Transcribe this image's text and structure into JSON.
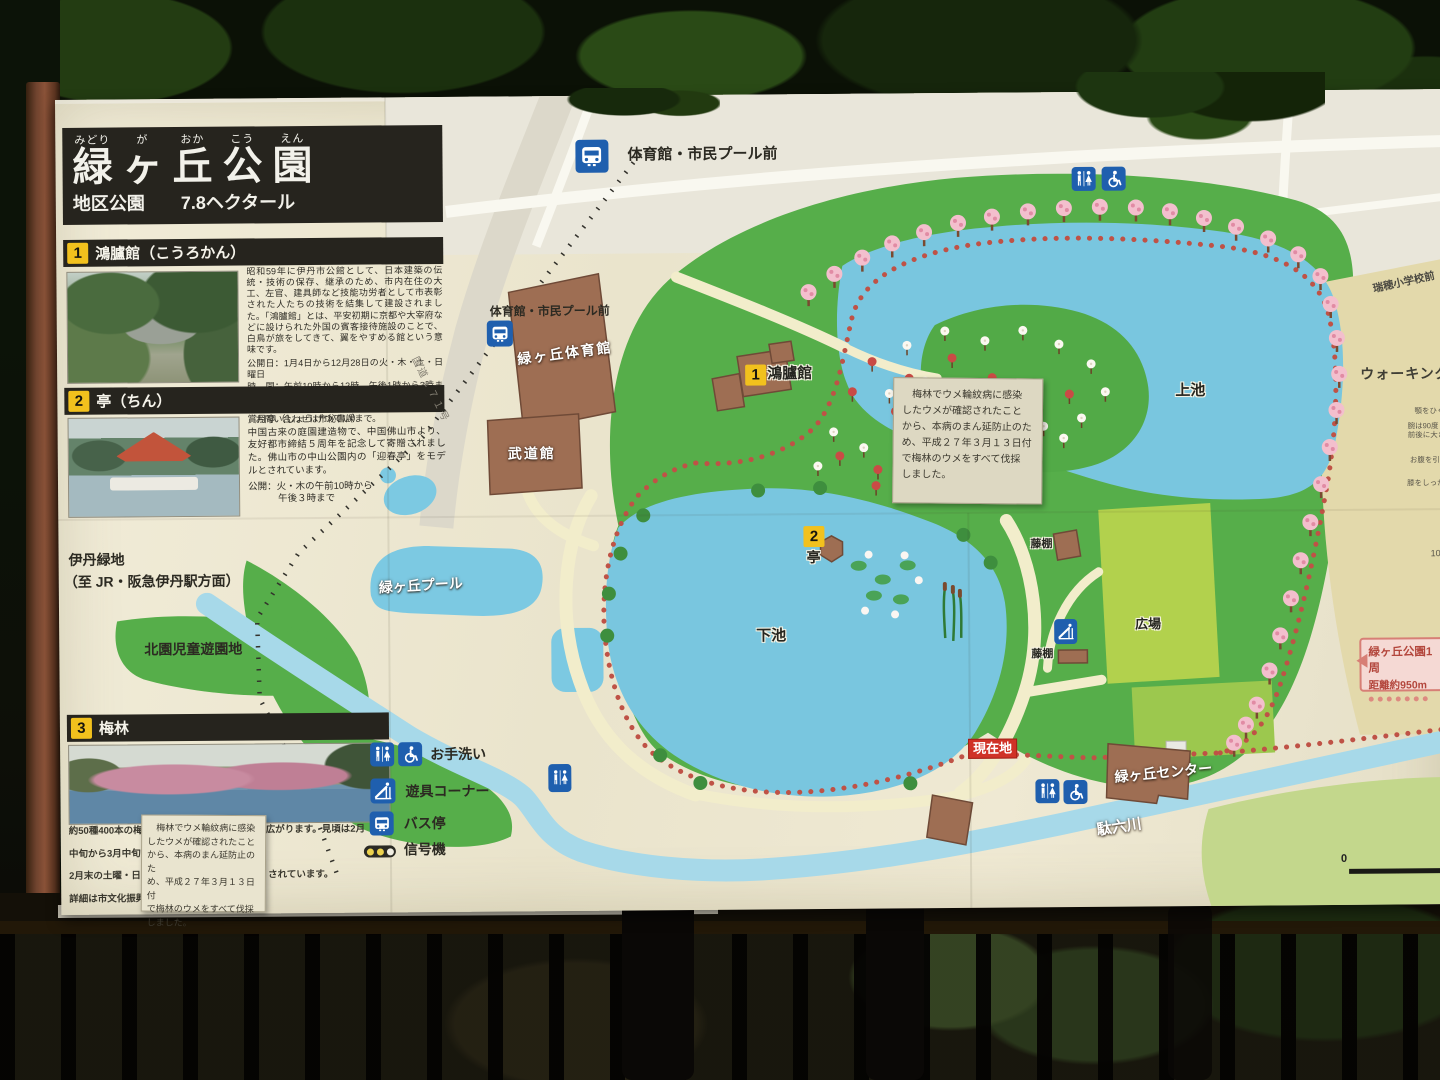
{
  "title": {
    "furigana": [
      "みどり",
      "が",
      "おか",
      "こう",
      "えん"
    ],
    "kanji": [
      "緑",
      "ヶ",
      "丘",
      "公",
      "園"
    ],
    "subtitle_left": "地区公園",
    "subtitle_right": "7.8ヘクタール"
  },
  "box1": {
    "num": "1",
    "heading": "鴻臚館（こうろかん）",
    "body": "昭和59年に伊丹市公館として、日本建築の伝統・技術の保存、継承のため、市内在住の大工、左官、建具師など技能功労者として市表彰された人たちの技術を結集して建設されました。「鴻臚館」とは、平安初期に京都や大宰府などに設けられた外国の賓客接待施設のことで、白鳥が旅をしてきて、翼をやすめる館という意味です。",
    "open_days": "公開日：1月4日から12月28日の火・木・土・日曜日",
    "open_hours": "時　間：午前10時から12時、午後1時から3時まで",
    "note1": "※行事等で見学できない場合もあります。",
    "note2": "お問い合わせは市秘書課まで。"
  },
  "box2": {
    "num": "2",
    "heading": "亭（ちん）",
    "subname": "賞月亭（しょうげつてい）",
    "body": "中国古来の庭園建造物で、中国佛山市より、友好都市締結５周年を記念して寄贈されました。佛山市の中山公園内の「迎春亭」をモデルとされています。",
    "open1": "公開：火・木の午前10時から",
    "open2": "午後３時まで"
  },
  "box3": {
    "num": "3",
    "heading": "梅林",
    "line1_left": "約50種400本の梅が",
    "line1_right": "広がります。見頃は2月",
    "line2_left": "中旬から3月中旬です",
    "line3_left": "2月末の土曜・日曜日",
    "line3_right": "されています。",
    "line4_left": "詳細は市文化振興課"
  },
  "plum_notice": {
    "l1": "　梅林でウメ輪紋病に感染",
    "l2": "したウメが確認されたこと",
    "l3": "から、本病のまん延防止のた",
    "l4": "め、平成２７年３月１３日付",
    "l5": "で梅林のウメをすべて伐採",
    "l6": "しました。"
  },
  "legend": {
    "toilet": "お手洗い",
    "playground": "遊具コーナー",
    "bus_stop": "バス停",
    "signal": "信号機"
  },
  "map_labels": {
    "bus_stop_top": "体育館・市民プール前",
    "bus_stop_gym": "体育館・市民プール前",
    "gym": "緑ヶ丘体育館",
    "budokan": "武道館",
    "pool": "緑ヶ丘プール",
    "kourokan_num": "1",
    "kourokan": "鴻臚館",
    "tei_num": "2",
    "tei": "亭",
    "upper_pond": "上池",
    "lower_pond": "下池",
    "fujidana_a": "藤棚",
    "fujidana_b": "藤棚",
    "hiroba": "広場",
    "center": "緑ヶ丘センター",
    "river": "駄六川",
    "current_location": "現在地",
    "kitazono": "北園児童遊園地",
    "itami_line1": "伊丹緑地",
    "itami_line2": "（至 JR・阪急伊丹駅方面）",
    "mizuho": "瑞穂小学校前",
    "road": "国道１７１号",
    "scale_zero": "0"
  },
  "walking": {
    "title": "ウォーキング",
    "tip1": "顎をひく",
    "tip2a": "腕は90度",
    "tip2b": "前後に大きくふる",
    "tip3": "お腹を引きしめて",
    "tip4": "膝をしっかり伸ばす",
    "fragment": "100",
    "loop_line1": "緑ヶ丘公園1周",
    "loop_line2": "距離約950m"
  },
  "colors": {
    "grass": "#56ae4a",
    "pond": "#79c6df",
    "building": "#9e6e53",
    "plaza": "#b2d14d",
    "legend_blue": "#1f5fae",
    "current_red": "#d03227",
    "title_bg": "#26241e",
    "num_yellow": "#f2c11d",
    "dotted_path": "#bf5246",
    "board": "#efead4"
  }
}
